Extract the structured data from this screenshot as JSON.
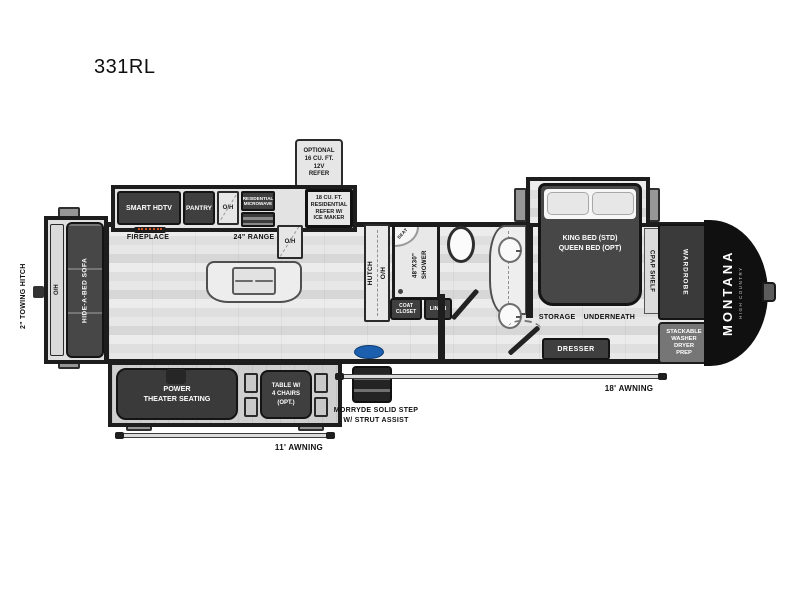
{
  "model": "331RL",
  "colors": {
    "wall": "#1d1d1d",
    "furniture_dark": "#3f3f3f",
    "cabinet_light": "#e6e6e6",
    "floor_light": "#e9e9e9",
    "front_cap": "#101010",
    "morryde_blue": "#1b5fae",
    "flame_accent": "#d4501e"
  },
  "exterior": {
    "towing_hitch": "2\" TOWING HITCH",
    "awning_door_side": "11' AWNING",
    "awning_front": "18' AWNING",
    "brand": "MONTANA",
    "brand_sub": "HIGH COUNTRY",
    "step_label": "MORRYDE SOLID STEP\nW/ STRUT ASSIST"
  },
  "living": {
    "optional_refer": "OPTIONAL\n16 CU. FT.\n12V\nREFER",
    "smart_hdtv": "SMART HDTV",
    "fireplace": "FIREPLACE",
    "pantry": "PANTRY",
    "oh_left": "O/H",
    "microwave": "RESIDENTIAL\nMICROWAVE",
    "oh_right": "O/H",
    "range": "24\" RANGE",
    "refer": "18 CU. FT.\nRESIDENTIAL\nREFER W/\nICE MAKER",
    "sofa_oh": "O/H",
    "sofa": "HIDE-A-BED SOFA",
    "theater_seating": "POWER\nTHEATER SEATING",
    "table": "TABLE W/\n4 CHAIRS\n(OPT.)",
    "hutch": "HUTCH\nO/H"
  },
  "bath": {
    "shower": "48\"X30\"\nSHOWER",
    "seat": "SEAT",
    "coat_closet": "COAT\nCLOSET",
    "linen": "LINEN"
  },
  "bedroom": {
    "bed": "KING BED (STD)\nQUEEN BED (OPT)",
    "cpap_shelf": "CPAP SHELF",
    "storage": "STORAGE UNDERNEATH",
    "dresser": "DRESSER",
    "wardrobe": "WARDROBE",
    "washer_prep": "STACKABLE\nWASHER\nDRYER\nPREP"
  }
}
